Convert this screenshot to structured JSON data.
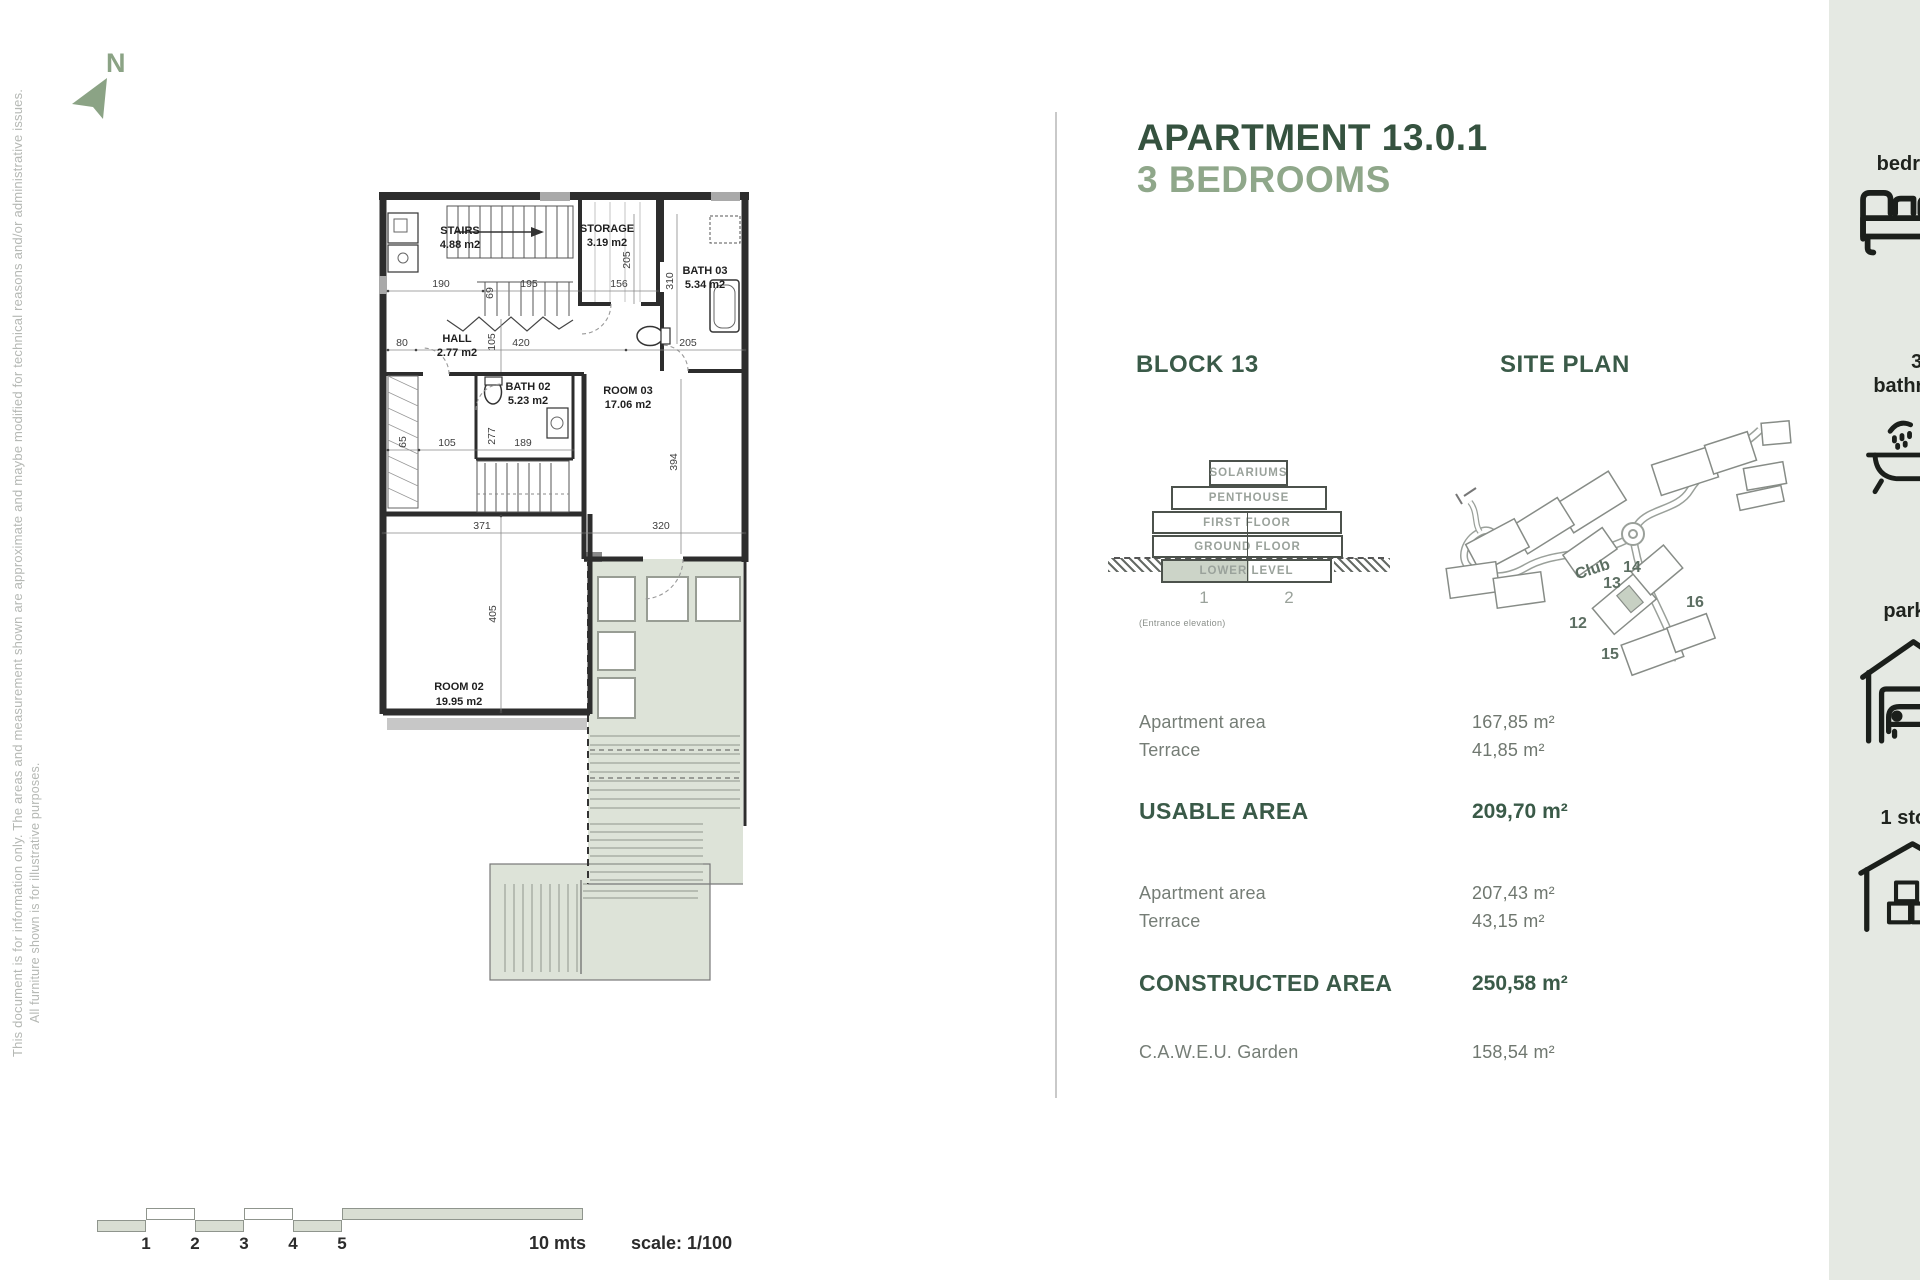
{
  "disclaimer": {
    "line1": "This document is for information only. The areas and measurement shown are approximate and maybe modified for technical reasons and/or administrative issues.",
    "line2": "All furniture shown is for illustrative purposes."
  },
  "compass": {
    "label": "N"
  },
  "header": {
    "title_line1": "APARTMENT 13.0.1",
    "title_line2": "3 BEDROOMS"
  },
  "sections": {
    "block_heading": "BLOCK 13",
    "site_plan_heading": "SITE PLAN"
  },
  "colors": {
    "accent_dark": "#35523f",
    "accent_sage": "#8fa78a",
    "sidebar_bg": "#e5e9e3",
    "terrace_fill": "#dde3d8"
  },
  "elevation": {
    "levels": [
      {
        "label": "SOLARIUMS"
      },
      {
        "label": "PENTHOUSE"
      },
      {
        "label": "FIRST FLOOR"
      },
      {
        "label": "GROUND FLOOR"
      },
      {
        "label": "LOWER LEVEL"
      }
    ],
    "unit1": "1",
    "unit2": "2",
    "caption": "(Entrance elevation)"
  },
  "site_plan": {
    "club": "Club",
    "b12": "12",
    "b13": "13",
    "b14": "14",
    "b15": "15",
    "b16": "16"
  },
  "areas": {
    "usable_rows": [
      {
        "label": "Apartment area",
        "value": "167,85 m²"
      },
      {
        "label": "Terrace",
        "value": "41,85 m²"
      }
    ],
    "usable_total_label": "USABLE AREA",
    "usable_total_value": "209,70 m²",
    "constructed_rows": [
      {
        "label": "Apartment area",
        "value": "207,43 m²"
      },
      {
        "label": "Terrace",
        "value": "43,15 m²"
      }
    ],
    "constructed_total_label": "CONSTRUCTED AREA",
    "constructed_total_value": "250,58 m²",
    "garden_label": "C.A.W.E.U. Garden",
    "garden_value": "158,54 m²"
  },
  "features": [
    {
      "line1": "3",
      "line2": "bedrooms",
      "icon": "bed-icon"
    },
    {
      "line1": "3,5",
      "line2": "bathrooms",
      "icon": "bathtub-icon"
    },
    {
      "line1": "2",
      "line2": "parkings",
      "icon": "garage-icon"
    },
    {
      "line1": "1 storage",
      "line2": "",
      "icon": "storage-icon"
    }
  ],
  "floor_plan": {
    "rooms": {
      "stairs": {
        "name": "STAIRS",
        "area": "4.88 m2"
      },
      "storage": {
        "name": "STORAGE",
        "area": "3.19 m2"
      },
      "bath03": {
        "name": "BATH 03",
        "area": "5.34 m2"
      },
      "hall": {
        "name": "HALL",
        "area": "2.77 m2"
      },
      "bath02": {
        "name": "BATH 02",
        "area": "5.23 m2"
      },
      "room03": {
        "name": "ROOM 03",
        "area": "17.06 m2"
      },
      "room02": {
        "name": "ROOM 02",
        "area": "19.95 m2"
      }
    },
    "dims": {
      "t190": "190",
      "t195": "195",
      "t156": "156",
      "r69": "69",
      "r205s": "205",
      "r310": "310",
      "h80": "80",
      "r105": "105",
      "h420": "420",
      "h205": "205",
      "m105": "105",
      "r277": "277",
      "m189": "189",
      "r65": "65",
      "r394": "394",
      "b371": "371",
      "b320": "320",
      "r405": "405"
    }
  },
  "scale_bar": {
    "tick1": "1",
    "tick2": "2",
    "tick3": "3",
    "tick4": "4",
    "tick5": "5",
    "end_label": "10 mts",
    "scale_label": "scale: 1/100"
  }
}
